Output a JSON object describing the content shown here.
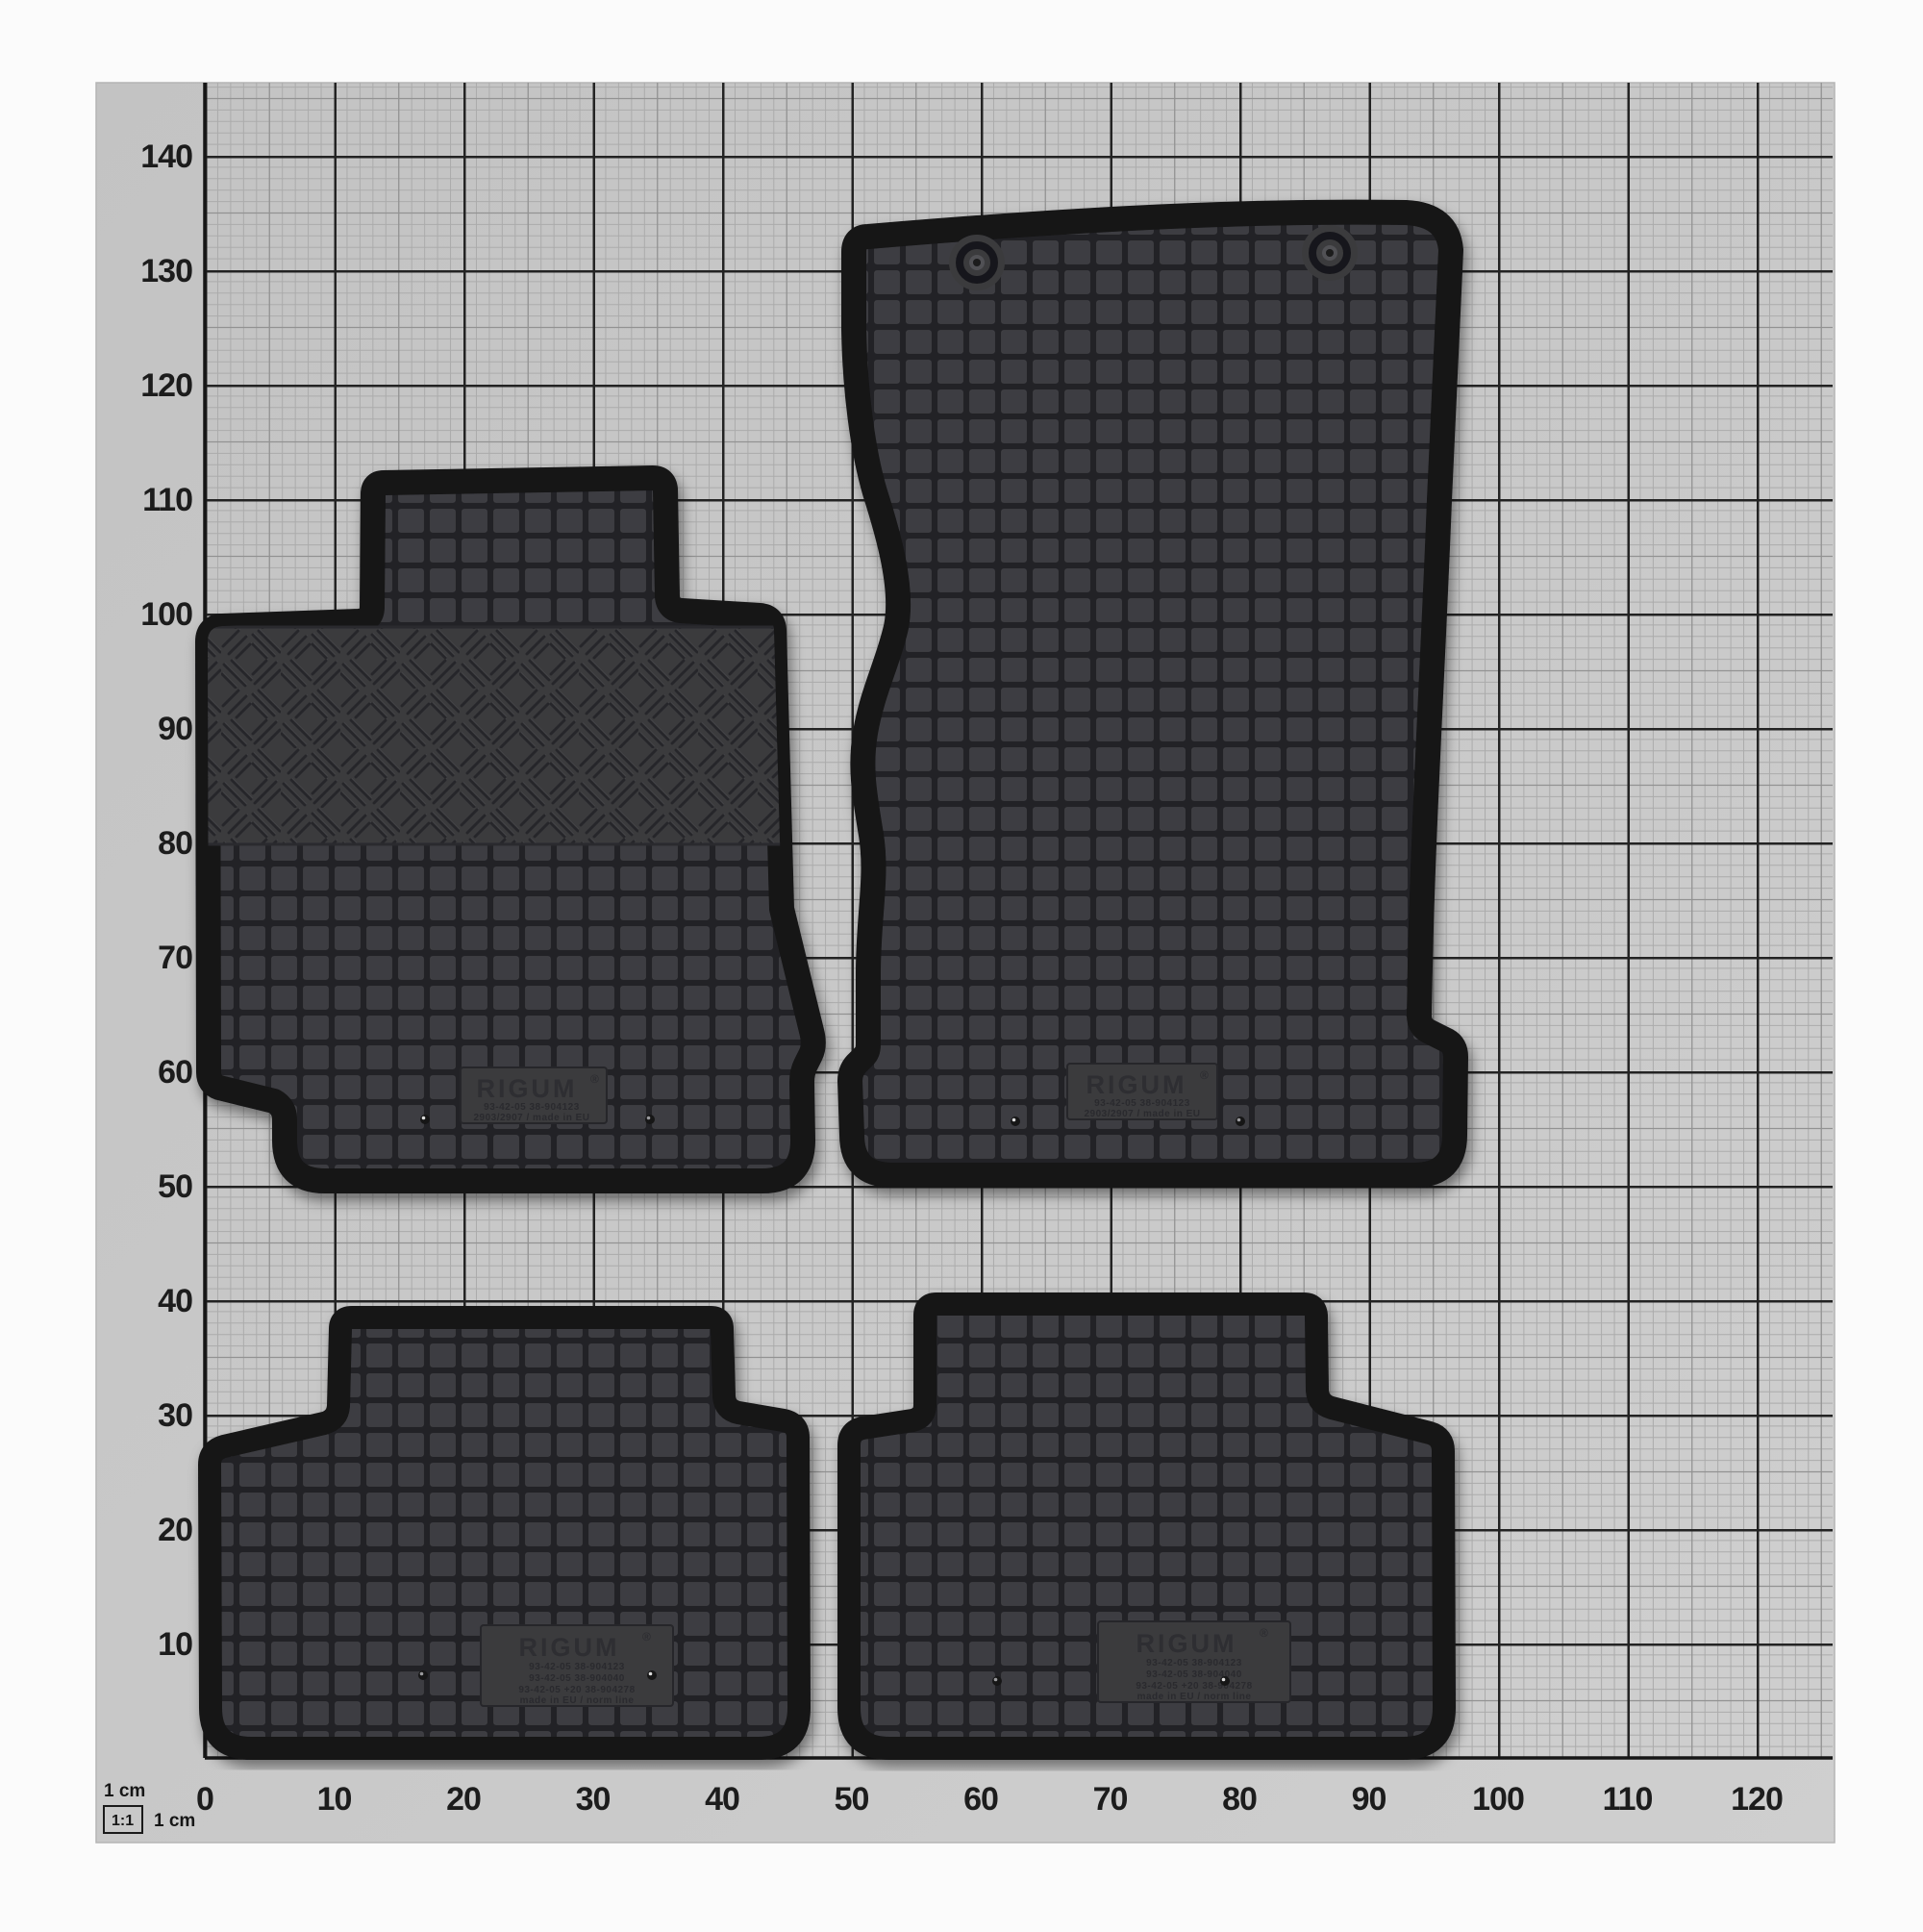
{
  "meta": {
    "description": "Product photo: set of four black RIGUM rubber car floor mats laid on centimetre graph paper",
    "scale_note": "1:1"
  },
  "legend": {
    "unit_top": "1 cm",
    "ratio": "1:1",
    "unit_side": "1 cm"
  },
  "ruler": {
    "unit": "cm",
    "x_labels": [
      "0",
      "10",
      "20",
      "30",
      "40",
      "50",
      "60",
      "70",
      "80",
      "90",
      "100",
      "110",
      "120"
    ],
    "y_labels": [
      "140",
      "130",
      "120",
      "110",
      "100",
      "90",
      "80",
      "70",
      "60",
      "50",
      "40",
      "30",
      "20",
      "10"
    ]
  },
  "mats": {
    "front_left": {
      "name": "front passenger mat",
      "brand": "RIGUM",
      "reg": "®",
      "line1": "93-42-05  38-904123",
      "line2": "2903/2907 / made in EU"
    },
    "front_right": {
      "name": "front driver mat",
      "brand": "RIGUM",
      "reg": "®",
      "line1": "93-42-05  38-904123",
      "line2": "2903/2907 / made in EU"
    },
    "rear_left": {
      "name": "rear left mat",
      "brand": "RIGUM",
      "reg": "®",
      "line1": "93-42-05  38-904123",
      "line2": "93-42-05  38-904040",
      "line3": "93-42-05 +20  38-904278",
      "line4": "made in EU / norm line"
    },
    "rear_right": {
      "name": "rear right mat",
      "brand": "RIGUM",
      "reg": "®",
      "line1": "93-42-05  38-904123",
      "line2": "93-42-05  38-904040",
      "line3": "93-42-05 +20  38-904278",
      "line4": "made in EU / norm line"
    }
  },
  "colors": {
    "background": "#fbfbfb",
    "paper": "#c9c9c9",
    "grid_minor": "#ababab",
    "grid_mid": "#929292",
    "grid_major": "#232323",
    "axis": "#161616",
    "tick_label": "#1c1c1c",
    "rubber_square": "#3e3e42",
    "rubber_groove": "#232327",
    "rim": "#141416"
  }
}
